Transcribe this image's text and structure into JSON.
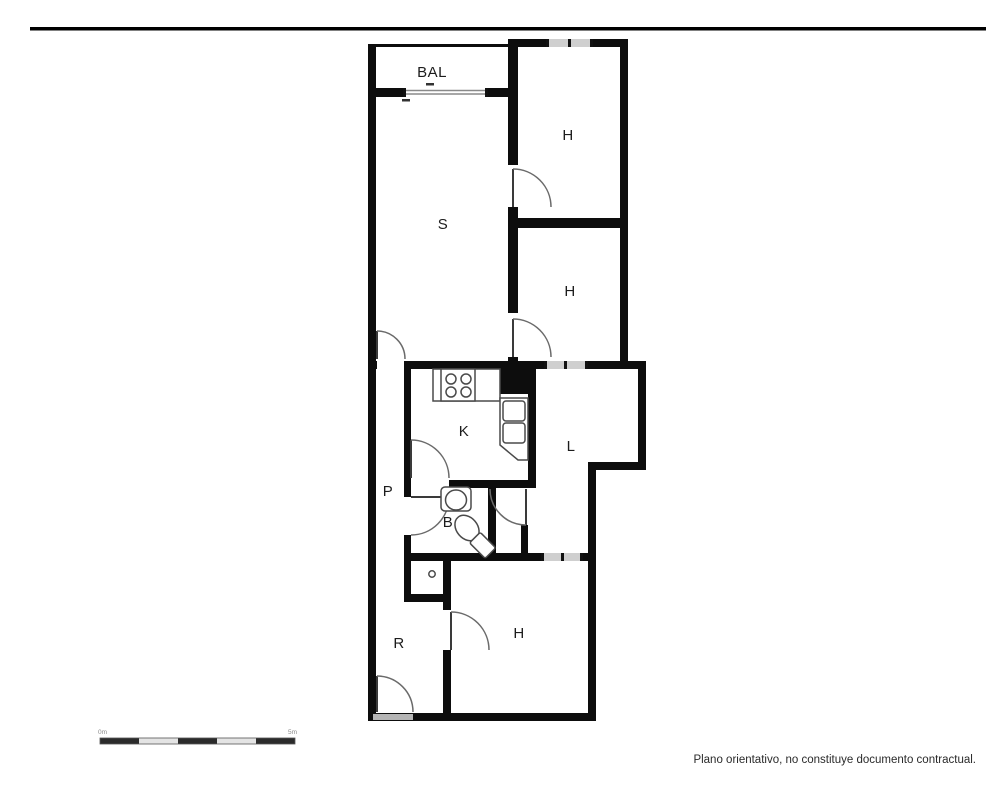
{
  "floorplan": {
    "rooms": [
      {
        "id": "balcony",
        "label": "BAL"
      },
      {
        "id": "bedroom-top",
        "label": "H"
      },
      {
        "id": "living-room",
        "label": "S"
      },
      {
        "id": "bedroom-middle",
        "label": "H"
      },
      {
        "id": "kitchen",
        "label": "K"
      },
      {
        "id": "living-area",
        "label": "L"
      },
      {
        "id": "hallway",
        "label": "P"
      },
      {
        "id": "bathroom",
        "label": "B"
      },
      {
        "id": "entry-hall",
        "label": "R"
      },
      {
        "id": "bedroom-bottom",
        "label": "H"
      }
    ],
    "fixtures": [
      "stove-burners",
      "kitchen-sink",
      "washbasin",
      "toilet",
      "shower-drain"
    ],
    "colors": {
      "wall": "#0d0d0d",
      "window": "#cfcfcf",
      "door": "#6a6a6a",
      "background": "#ffffff"
    }
  },
  "scale_bar": {
    "start_label": "0m",
    "end_label": "5m"
  },
  "footer": {
    "disclaimer": "Plano orientativo, no constituye documento contractual."
  }
}
